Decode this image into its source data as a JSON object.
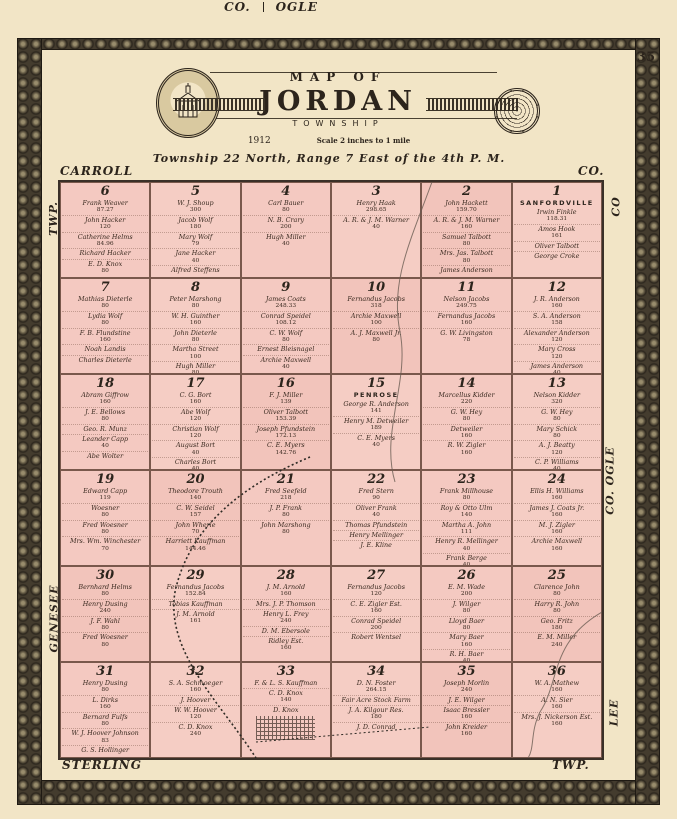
{
  "page": {
    "number": "35"
  },
  "header": {
    "map_of": "MAP OF",
    "title": "JORDAN",
    "subtitle": "TOWNSHIP",
    "year": "1912",
    "scale": "Scale 2 inches to 1 mile",
    "township_line": "Township 22 North, Range 7 East of the 4th P. M."
  },
  "margins": {
    "top_left": "CARROLL",
    "top_center_left": "CO.",
    "top_center_right": "OGLE",
    "top_right": "CO.",
    "left_top": "TWP.",
    "left_bottom": "GENESEE",
    "right_top": "CO",
    "right_middle": "CO. OGLE",
    "right_bottom": "LEE",
    "bottom_left": "STERLING",
    "bottom_right": "TWP."
  },
  "colors": {
    "paper": "#f2e5c6",
    "land_pink": "#f4c9c1",
    "border_band": "#443c2e",
    "ink": "#2c241c"
  },
  "map": {
    "sections": [
      {
        "number": "6",
        "place": "",
        "owners": [
          {
            "name": "Frank Weaver",
            "acres": "87.27"
          },
          {
            "name": "John Hacker",
            "acres": "120"
          },
          {
            "name": "Catherine Helms",
            "acres": "84.96"
          },
          {
            "name": "Richard Hacker",
            "acres": ""
          },
          {
            "name": "E. D. Knox",
            "acres": "80"
          }
        ]
      },
      {
        "number": "5",
        "place": "",
        "owners": [
          {
            "name": "W. J. Shoup",
            "acres": "300"
          },
          {
            "name": "Jacob Wolf",
            "acres": "180"
          },
          {
            "name": "Mary Wolf",
            "acres": "79"
          },
          {
            "name": "Jane Hacker",
            "acres": "40"
          },
          {
            "name": "Alfred Steffens",
            "acres": ""
          }
        ]
      },
      {
        "number": "4",
        "place": "",
        "owners": [
          {
            "name": "Carl Bauer",
            "acres": "80"
          },
          {
            "name": "N. B. Crary",
            "acres": "200"
          },
          {
            "name": "Hugh Miller",
            "acres": "40"
          }
        ]
      },
      {
        "number": "3",
        "place": "",
        "owners": [
          {
            "name": "Henry Haak",
            "acres": "298.65"
          },
          {
            "name": "A. R. & J. M. Warner",
            "acres": "40"
          }
        ]
      },
      {
        "number": "2",
        "place": "",
        "owners": [
          {
            "name": "John Hackett",
            "acres": "159.70"
          },
          {
            "name": "A. R. & J. M. Warner",
            "acres": "160"
          },
          {
            "name": "Samuel Talbott",
            "acres": "80"
          },
          {
            "name": "Mrs. Jas. Talbott",
            "acres": "80"
          },
          {
            "name": "James Anderson",
            "acres": ""
          }
        ]
      },
      {
        "number": "1",
        "place": "SANFORDVILLE",
        "owners": [
          {
            "name": "Irwin Finkle",
            "acres": "118.31"
          },
          {
            "name": "Amos Hook",
            "acres": "161"
          },
          {
            "name": "Oliver Talbott",
            "acres": ""
          },
          {
            "name": "George Croke",
            "acres": ""
          }
        ]
      },
      {
        "number": "7",
        "place": "",
        "owners": [
          {
            "name": "Mathias Dieterle",
            "acres": "80"
          },
          {
            "name": "Lydia Wolf",
            "acres": "80"
          },
          {
            "name": "F. B. Flundstine",
            "acres": "160"
          },
          {
            "name": "Noah Landis",
            "acres": ""
          },
          {
            "name": "Charles Dieterle",
            "acres": ""
          }
        ]
      },
      {
        "number": "8",
        "place": "",
        "owners": [
          {
            "name": "Peter Marshong",
            "acres": "80"
          },
          {
            "name": "W. H. Guinther",
            "acres": "160"
          },
          {
            "name": "John Dieterle",
            "acres": "80"
          },
          {
            "name": "Martha Street",
            "acres": "100"
          },
          {
            "name": "Hugh Miller",
            "acres": "80"
          },
          {
            "name": "John Dickinson",
            "acres": "60"
          }
        ]
      },
      {
        "number": "9",
        "place": "",
        "owners": [
          {
            "name": "James Coats",
            "acres": "248.33"
          },
          {
            "name": "Conrad Speidel",
            "acres": "108.12"
          },
          {
            "name": "C. W. Wolf",
            "acres": "80"
          },
          {
            "name": "Ernest Bleisnagel",
            "acres": ""
          },
          {
            "name": "Archie Maxwell",
            "acres": "40"
          }
        ]
      },
      {
        "number": "10",
        "place": "",
        "owners": [
          {
            "name": "Fernandus Jacobs",
            "acres": "318"
          },
          {
            "name": "Archie Maxwell",
            "acres": "100"
          },
          {
            "name": "A. J. Maxwell Jr.",
            "acres": "80"
          }
        ]
      },
      {
        "number": "11",
        "place": "",
        "owners": [
          {
            "name": "Nelson Jacobs",
            "acres": "249.75"
          },
          {
            "name": "Fernandus Jacobs",
            "acres": "160"
          },
          {
            "name": "G. W. Livingston",
            "acres": "78"
          }
        ]
      },
      {
        "number": "12",
        "place": "",
        "owners": [
          {
            "name": "J. R. Anderson",
            "acres": "160"
          },
          {
            "name": "S. A. Anderson",
            "acres": "158"
          },
          {
            "name": "Alexander Anderson",
            "acres": "120"
          },
          {
            "name": "Mary Cross",
            "acres": "120"
          },
          {
            "name": "James Anderson",
            "acres": "40"
          }
        ]
      },
      {
        "number": "18",
        "place": "",
        "owners": [
          {
            "name": "Abram Giffrow",
            "acres": "160"
          },
          {
            "name": "J. E. Bellows",
            "acres": "80"
          },
          {
            "name": "Geo. R. Munz",
            "acres": ""
          },
          {
            "name": "Leander Capp",
            "acres": "40"
          },
          {
            "name": "Abe Wolter",
            "acres": ""
          }
        ]
      },
      {
        "number": "17",
        "place": "",
        "owners": [
          {
            "name": "C. G. Bort",
            "acres": "160"
          },
          {
            "name": "Abe Wolf",
            "acres": "120"
          },
          {
            "name": "Christian Wolf",
            "acres": "120"
          },
          {
            "name": "August Bort",
            "acres": "40"
          },
          {
            "name": "Charles Bort",
            "acres": "40"
          }
        ]
      },
      {
        "number": "16",
        "place": "",
        "owners": [
          {
            "name": "F. J. Miller",
            "acres": "139"
          },
          {
            "name": "Oliver Talbott",
            "acres": "153.39"
          },
          {
            "name": "Joseph Pfundstein",
            "acres": "172.13"
          },
          {
            "name": "C. E. Myers",
            "acres": "142.76"
          }
        ]
      },
      {
        "number": "15",
        "place": "PENROSE",
        "owners": [
          {
            "name": "George R. Anderson",
            "acres": "141"
          },
          {
            "name": "Henry M. Detweiler",
            "acres": "189"
          },
          {
            "name": "C. E. Myers",
            "acres": "40"
          }
        ]
      },
      {
        "number": "14",
        "place": "",
        "owners": [
          {
            "name": "Marcellus Kidder",
            "acres": "220"
          },
          {
            "name": "G. W. Hey",
            "acres": "80"
          },
          {
            "name": "Detweiler",
            "acres": "160"
          },
          {
            "name": "R. W. Zigler",
            "acres": "160"
          }
        ]
      },
      {
        "number": "13",
        "place": "",
        "owners": [
          {
            "name": "Nelson Kidder",
            "acres": "320"
          },
          {
            "name": "G. W. Hey",
            "acres": "80"
          },
          {
            "name": "Mary Schick",
            "acres": "80"
          },
          {
            "name": "A. J. Beatty",
            "acres": "120"
          },
          {
            "name": "C. P. Williams",
            "acres": "40"
          }
        ]
      },
      {
        "number": "19",
        "place": "",
        "owners": [
          {
            "name": "Edward Capp",
            "acres": "119"
          },
          {
            "name": "Woesner",
            "acres": "80"
          },
          {
            "name": "Fred Woesner",
            "acres": "80"
          },
          {
            "name": "Mrs. Wm. Winchester",
            "acres": "70"
          }
        ]
      },
      {
        "number": "20",
        "place": "",
        "owners": [
          {
            "name": "Theodore Trouth",
            "acres": "140"
          },
          {
            "name": "C. W. Seidel",
            "acres": "157"
          },
          {
            "name": "John Wherle",
            "acres": "70"
          },
          {
            "name": "Harriett Kauffman",
            "acres": "144.46"
          }
        ]
      },
      {
        "number": "21",
        "place": "",
        "owners": [
          {
            "name": "Fred Seefeld",
            "acres": "218"
          },
          {
            "name": "J. P. Frank",
            "acres": "80"
          },
          {
            "name": "John Marshong",
            "acres": "80"
          }
        ]
      },
      {
        "number": "22",
        "place": "",
        "owners": [
          {
            "name": "Fred Stern",
            "acres": "90"
          },
          {
            "name": "Oliver Frank",
            "acres": "40"
          },
          {
            "name": "Thomas Pfundstein",
            "acres": ""
          },
          {
            "name": "Henry Mellinger",
            "acres": ""
          },
          {
            "name": "J. E. Kline",
            "acres": ""
          }
        ]
      },
      {
        "number": "23",
        "place": "",
        "owners": [
          {
            "name": "Frank Millhouse",
            "acres": "80"
          },
          {
            "name": "Roy & Otto Ulm",
            "acres": "140"
          },
          {
            "name": "Martha A. John",
            "acres": "111"
          },
          {
            "name": "Henry R. Mellinger",
            "acres": "40"
          },
          {
            "name": "Frank Berge",
            "acres": "40"
          }
        ]
      },
      {
        "number": "24",
        "place": "",
        "owners": [
          {
            "name": "Ellis H. Williams",
            "acres": "160"
          },
          {
            "name": "James J. Coats Jr.",
            "acres": "160"
          },
          {
            "name": "M. J. Zigler",
            "acres": "160"
          },
          {
            "name": "Archie Maxwell",
            "acres": "160"
          }
        ]
      },
      {
        "number": "30",
        "place": "",
        "owners": [
          {
            "name": "Bernhard Helms",
            "acres": "80"
          },
          {
            "name": "Henry Dusing",
            "acres": "240"
          },
          {
            "name": "J. F. Wahl",
            "acres": "80"
          },
          {
            "name": "Fred Woesner",
            "acres": "80"
          }
        ]
      },
      {
        "number": "29",
        "place": "",
        "owners": [
          {
            "name": "Fernandus Jacobs",
            "acres": "152.84"
          },
          {
            "name": "Tobias Kauffman",
            "acres": ""
          },
          {
            "name": "J. M. Arnold",
            "acres": "161"
          }
        ]
      },
      {
        "number": "28",
        "place": "",
        "owners": [
          {
            "name": "J. M. Arnold",
            "acres": "160"
          },
          {
            "name": "Mrs. J. P. Thomson",
            "acres": ""
          },
          {
            "name": "Henry L. Frey",
            "acres": "240"
          },
          {
            "name": "D. M. Ebersole",
            "acres": ""
          },
          {
            "name": "Ridley Est.",
            "acres": "160"
          }
        ]
      },
      {
        "number": "27",
        "place": "",
        "owners": [
          {
            "name": "Fernandus Jacobs",
            "acres": "120"
          },
          {
            "name": "C. E. Zigler Est.",
            "acres": "160"
          },
          {
            "name": "Conrad Speidel",
            "acres": "200"
          },
          {
            "name": "Robert Wentsel",
            "acres": ""
          }
        ]
      },
      {
        "number": "26",
        "place": "",
        "owners": [
          {
            "name": "E. M. Wade",
            "acres": "200"
          },
          {
            "name": "J. Wilger",
            "acres": "80"
          },
          {
            "name": "Lloyd Baer",
            "acres": "80"
          },
          {
            "name": "Mary Baer",
            "acres": "160"
          },
          {
            "name": "R. H. Baer",
            "acres": "40"
          }
        ]
      },
      {
        "number": "25",
        "place": "",
        "owners": [
          {
            "name": "Clarence John",
            "acres": "80"
          },
          {
            "name": "Harry R. John",
            "acres": "80"
          },
          {
            "name": "Geo. Fritz",
            "acres": "180"
          },
          {
            "name": "E. M. Miller",
            "acres": "240"
          }
        ]
      },
      {
        "number": "31",
        "place": "",
        "owners": [
          {
            "name": "Henry Dusing",
            "acres": "80"
          },
          {
            "name": "L. Dirks",
            "acres": "160"
          },
          {
            "name": "Bernard Fulfs",
            "acres": "80"
          },
          {
            "name": "W. J. Hoover Johnson",
            "acres": "83"
          },
          {
            "name": "G. S. Hollinger",
            "acres": ""
          }
        ]
      },
      {
        "number": "32",
        "place": "",
        "owners": [
          {
            "name": "S. A. Schmoeger",
            "acres": "160"
          },
          {
            "name": "J. Hoover",
            "acres": ""
          },
          {
            "name": "W. W. Hoover",
            "acres": "120"
          },
          {
            "name": "C. D. Knox",
            "acres": "240"
          }
        ]
      },
      {
        "number": "33",
        "place": "",
        "village": true,
        "owners": [
          {
            "name": "F. & L. S. Kauffman",
            "acres": ""
          },
          {
            "name": "C. D. Knox",
            "acres": "140"
          },
          {
            "name": "D. Knox",
            "acres": ""
          }
        ]
      },
      {
        "number": "34",
        "place": "",
        "owners": [
          {
            "name": "D. N. Foster",
            "acres": "264.15"
          },
          {
            "name": "Fair Acre Stock Farm",
            "acres": ""
          },
          {
            "name": "J. A. Kilgour Res.",
            "acres": "180"
          },
          {
            "name": "J. D. Conrad",
            "acres": ""
          }
        ]
      },
      {
        "number": "35",
        "place": "",
        "owners": [
          {
            "name": "Joseph Morlin",
            "acres": "240"
          },
          {
            "name": "J. E. Wilger",
            "acres": ""
          },
          {
            "name": "Isaac Bressler",
            "acres": "160"
          },
          {
            "name": "John Kreider",
            "acres": "160"
          }
        ]
      },
      {
        "number": "36",
        "place": "",
        "owners": [
          {
            "name": "W. A. Mathew",
            "acres": "160"
          },
          {
            "name": "A. N. Sier",
            "acres": "160"
          },
          {
            "name": "Mrs. J. Nickerson Est.",
            "acres": "160"
          }
        ]
      }
    ]
  }
}
